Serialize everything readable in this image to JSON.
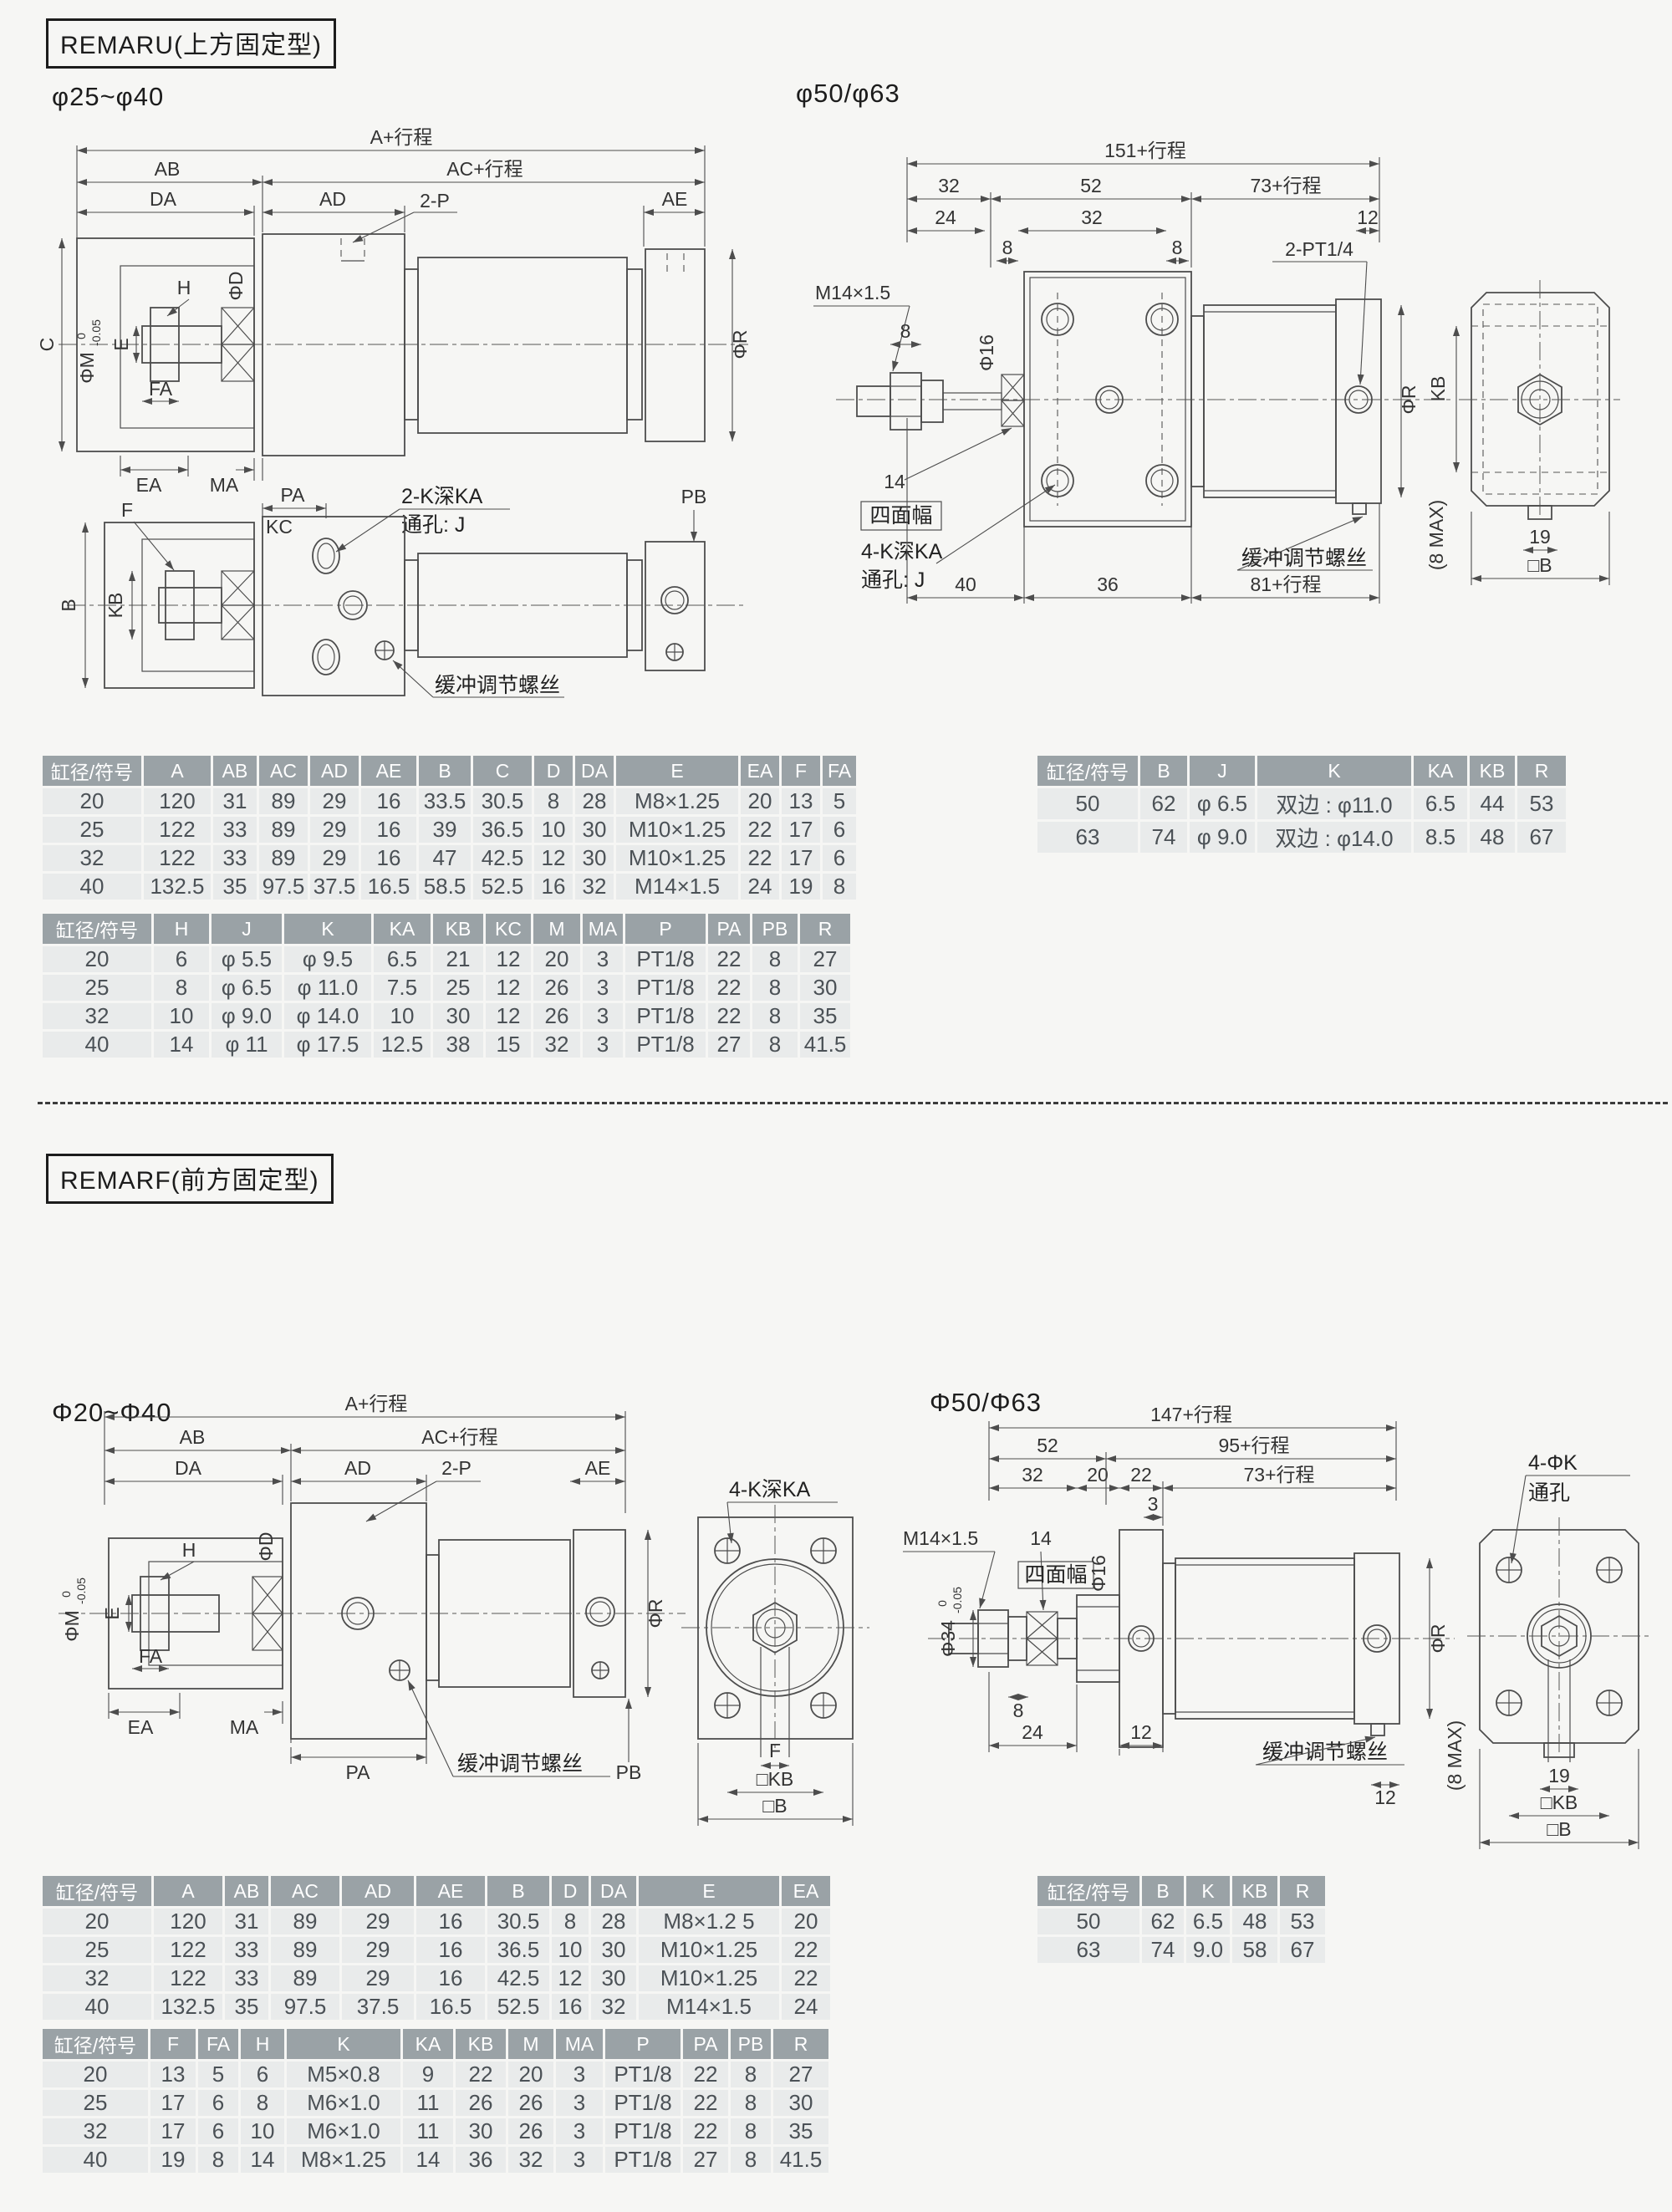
{
  "colors": {
    "page_bg": "#f6f6f4",
    "table_header_bg": "#9aa2a6",
    "table_header_text": "#ffffff",
    "table_row_bg": "#e9ebeb",
    "body_text": "#4b5156",
    "line": "#4d4d4d"
  },
  "remaru": {
    "title": "REMARU(上方固定型)",
    "bore_small": "φ25~φ40",
    "bore_large": "φ50/φ63",
    "d1": {
      "a": "A+行程",
      "ab": "AB",
      "ac": "AC+行程",
      "da": "DA",
      "ad": "AD",
      "p2": "2-P",
      "ae": "AE",
      "c": "C",
      "phim": "ΦM",
      "tol0": "0",
      "tol1": "-0.05",
      "e": "E",
      "h": "H",
      "phid": "ΦD",
      "fa": "FA",
      "ea": "EA",
      "ma": "MA",
      "phir": "ΦR"
    },
    "d2": {
      "f": "F",
      "pa": "PA",
      "kc": "KC",
      "ka": "2-K深KA",
      "tj": "通孔: J",
      "pb": "PB",
      "b": "B",
      "kb": "KB",
      "cushion": "缓冲调节螺丝"
    },
    "d3": {
      "l151": "151+行程",
      "n32a": "32",
      "n52": "52",
      "l73": "73+行程",
      "n24": "24",
      "n32b": "32",
      "n8a": "8",
      "n8b": "8",
      "n12": "12",
      "m14": "M14×1.5",
      "n8c": "8",
      "phi16": "Φ16",
      "pt14": "2-PT1/4",
      "n14": "14",
      "smf": "四面幅",
      "ka": "4-K深KA",
      "tj": "通孔: J",
      "cushion": "缓冲调节螺丝",
      "n40": "40",
      "n36": "36",
      "l81": "81+行程",
      "phir": "ΦR"
    },
    "d4": {
      "kb": "KB",
      "n19": "19",
      "b": "□B",
      "max": "(8 MAX)"
    },
    "t1": {
      "headers": [
        "缸径/符号",
        "A",
        "AB",
        "AC",
        "AD",
        "AE",
        "B",
        "C",
        "D",
        "DA",
        "E",
        "EA",
        "F",
        "FA"
      ],
      "rows": [
        [
          "20",
          "120",
          "31",
          "89",
          "29",
          "16",
          "33.5",
          "30.5",
          "8",
          "28",
          "M8×1.25",
          "20",
          "13",
          "5"
        ],
        [
          "25",
          "122",
          "33",
          "89",
          "29",
          "16",
          "39",
          "36.5",
          "10",
          "30",
          "M10×1.25",
          "22",
          "17",
          "6"
        ],
        [
          "32",
          "122",
          "33",
          "89",
          "29",
          "16",
          "47",
          "42.5",
          "12",
          "30",
          "M10×1.25",
          "22",
          "17",
          "6"
        ],
        [
          "40",
          "132.5",
          "35",
          "97.5",
          "37.5",
          "16.5",
          "58.5",
          "52.5",
          "16",
          "32",
          "M14×1.5",
          "24",
          "19",
          "8"
        ]
      ]
    },
    "t2": {
      "headers": [
        "缸径/符号",
        "H",
        "J",
        "K",
        "KA",
        "KB",
        "KC",
        "M",
        "MA",
        "P",
        "PA",
        "PB",
        "R"
      ],
      "rows": [
        [
          "20",
          "6",
          "φ 5.5",
          "φ 9.5",
          "6.5",
          "21",
          "12",
          "20",
          "3",
          "PT1/8",
          "22",
          "8",
          "27"
        ],
        [
          "25",
          "8",
          "φ 6.5",
          "φ 11.0",
          "7.5",
          "25",
          "12",
          "26",
          "3",
          "PT1/8",
          "22",
          "8",
          "30"
        ],
        [
          "32",
          "10",
          "φ 9.0",
          "φ 14.0",
          "10",
          "30",
          "12",
          "26",
          "3",
          "PT1/8",
          "22",
          "8",
          "35"
        ],
        [
          "40",
          "14",
          "φ 11",
          "φ 17.5",
          "12.5",
          "38",
          "15",
          "32",
          "3",
          "PT1/8",
          "27",
          "8",
          "41.5"
        ]
      ]
    },
    "t3": {
      "headers": [
        "缸径/符号",
        "B",
        "J",
        "K",
        "KA",
        "KB",
        "R"
      ],
      "rows": [
        [
          "50",
          "62",
          "φ 6.5",
          "双边 : φ11.0",
          "6.5",
          "44",
          "53"
        ],
        [
          "63",
          "74",
          "φ 9.0",
          "双边 : φ14.0",
          "8.5",
          "48",
          "67"
        ]
      ]
    }
  },
  "remarf": {
    "title": "REMARF(前方固定型)",
    "bore_small": "Φ20~Φ40",
    "bore_large": "Φ50/Φ63",
    "d5": {
      "a": "A+行程",
      "ab": "AB",
      "ac": "AC+行程",
      "da": "DA",
      "ad": "AD",
      "p2": "2-P",
      "ae": "AE",
      "h": "H",
      "phid": "ΦD",
      "phim": "ΦM",
      "tol0": "0",
      "tol1": "-0.05",
      "e": "E",
      "fa": "FA",
      "ea": "EA",
      "ma": "MA",
      "pa": "PA",
      "cushion": "缓冲调节螺丝",
      "pb": "PB",
      "phir": "ΦR"
    },
    "d6": {
      "ka": "4-K深KA",
      "f": "F",
      "kb": "□KB",
      "b": "□B"
    },
    "d7": {
      "l147": "147+行程",
      "n52": "52",
      "l95": "95+行程",
      "n32": "32",
      "n20": "20",
      "n22": "22",
      "l73": "73+行程",
      "n3": "3",
      "m14": "M14×1.5",
      "n14": "14",
      "smf": "四面幅",
      "phi16": "Φ16",
      "pt14": "2-PT1/4",
      "phi34": "Φ34",
      "tol0": "0",
      "tol1": "-0.05",
      "n8": "8",
      "n24": "24",
      "n12a": "12",
      "cushion": "缓冲调节螺丝",
      "n12b": "12",
      "phir": "ΦR"
    },
    "d8": {
      "k4": "4-ΦK",
      "tk": "通孔",
      "n19": "19",
      "kb": "□KB",
      "b": "□B",
      "max": "(8 MAX)"
    },
    "t1": {
      "headers": [
        "缸径/符号",
        "A",
        "AB",
        "AC",
        "AD",
        "AE",
        "B",
        "D",
        "DA",
        "E",
        "EA"
      ],
      "rows": [
        [
          "20",
          "120",
          "31",
          "89",
          "29",
          "16",
          "30.5",
          "8",
          "28",
          "M8×1.2 5",
          "20"
        ],
        [
          "25",
          "122",
          "33",
          "89",
          "29",
          "16",
          "36.5",
          "10",
          "30",
          "M10×1.25",
          "22"
        ],
        [
          "32",
          "122",
          "33",
          "89",
          "29",
          "16",
          "42.5",
          "12",
          "30",
          "M10×1.25",
          "22"
        ],
        [
          "40",
          "132.5",
          "35",
          "97.5",
          "37.5",
          "16.5",
          "52.5",
          "16",
          "32",
          "M14×1.5",
          "24"
        ]
      ]
    },
    "t2": {
      "headers": [
        "缸径/符号",
        "F",
        "FA",
        "H",
        "K",
        "KA",
        "KB",
        "M",
        "MA",
        "P",
        "PA",
        "PB",
        "R"
      ],
      "rows": [
        [
          "20",
          "13",
          "5",
          "6",
          "M5×0.8",
          "9",
          "22",
          "20",
          "3",
          "PT1/8",
          "22",
          "8",
          "27"
        ],
        [
          "25",
          "17",
          "6",
          "8",
          "M6×1.0",
          "11",
          "26",
          "26",
          "3",
          "PT1/8",
          "22",
          "8",
          "30"
        ],
        [
          "32",
          "17",
          "6",
          "10",
          "M6×1.0",
          "11",
          "30",
          "26",
          "3",
          "PT1/8",
          "22",
          "8",
          "35"
        ],
        [
          "40",
          "19",
          "8",
          "14",
          "M8×1.25",
          "14",
          "36",
          "32",
          "3",
          "PT1/8",
          "27",
          "8",
          "41.5"
        ]
      ]
    },
    "t3": {
      "headers": [
        "缸径/符号",
        "B",
        "K",
        "KB",
        "R"
      ],
      "rows": [
        [
          "50",
          "62",
          "6.5",
          "48",
          "53"
        ],
        [
          "63",
          "74",
          "9.0",
          "58",
          "67"
        ]
      ]
    }
  }
}
